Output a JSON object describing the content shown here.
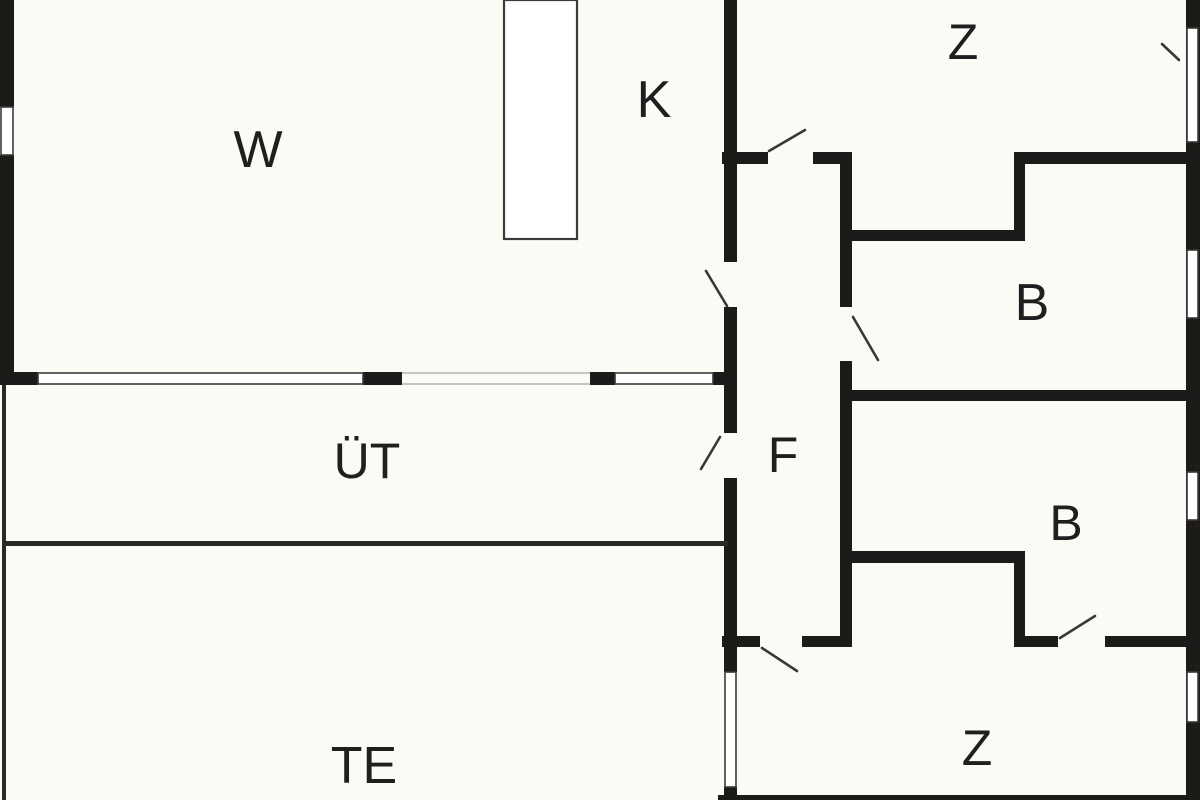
{
  "plan": {
    "title_hidden": "",
    "canvas": {
      "width": 1200,
      "height": 800
    },
    "colors": {
      "background": "#fbfaf4",
      "wall": "#1d1b19",
      "thin_wall": "#2b2926",
      "window_fill": "#ffffff",
      "window_stroke": "#3c3a38",
      "guide": "#b5b2ac",
      "door_swing": "#3a3836",
      "partition_stroke": "#3a3a3a",
      "label": "#1f1f1f"
    },
    "rooms": [
      {
        "id": "w",
        "label": "W",
        "x": 258,
        "y": 150,
        "size": 52
      },
      {
        "id": "k",
        "label": "K",
        "x": 654,
        "y": 100,
        "size": 52
      },
      {
        "id": "z-top",
        "label": "Z",
        "x": 963,
        "y": 42,
        "size": 50
      },
      {
        "id": "b-top",
        "label": "B",
        "x": 1032,
        "y": 303,
        "size": 52
      },
      {
        "id": "uet",
        "label": "ÜT",
        "x": 367,
        "y": 461,
        "size": 50
      },
      {
        "id": "f",
        "label": "F",
        "x": 783,
        "y": 455,
        "size": 50
      },
      {
        "id": "b-bottom",
        "label": "B",
        "x": 1066,
        "y": 523,
        "size": 50
      },
      {
        "id": "te",
        "label": "TE",
        "x": 364,
        "y": 766,
        "size": 52
      },
      {
        "id": "z-bottom",
        "label": "Z",
        "x": 977,
        "y": 748,
        "size": 50
      }
    ],
    "walls": [
      {
        "name": "outer-left-wall-top",
        "x": 0,
        "y": 0,
        "w": 14,
        "h": 107
      },
      {
        "name": "outer-left-wall-main",
        "x": 0,
        "y": 155,
        "w": 14,
        "h": 230
      },
      {
        "name": "w-south-wall-seg1",
        "x": 0,
        "y": 372,
        "w": 38,
        "h": 13
      },
      {
        "name": "w-south-wall-seg2",
        "x": 363,
        "y": 372,
        "w": 39,
        "h": 13
      },
      {
        "name": "w-south-wall-seg3",
        "x": 590,
        "y": 372,
        "w": 25,
        "h": 13
      },
      {
        "name": "w-south-wall-seg4",
        "x": 713,
        "y": 372,
        "w": 24,
        "h": 13
      },
      {
        "name": "k-z-divider-wall",
        "x": 724,
        "y": 0,
        "w": 13,
        "h": 262
      },
      {
        "name": "f-west-wall-mid",
        "x": 724,
        "y": 307,
        "w": 13,
        "h": 126
      },
      {
        "name": "f-west-wall-low",
        "x": 724,
        "y": 478,
        "w": 13,
        "h": 194
      },
      {
        "name": "te-z-divider-wall-stub",
        "x": 724,
        "y": 787,
        "w": 13,
        "h": 13
      },
      {
        "name": "z-top-south-wall-left-a",
        "x": 722,
        "y": 152,
        "w": 46,
        "h": 12
      },
      {
        "name": "z-top-south-wall-left-b",
        "x": 813,
        "y": 152,
        "w": 39,
        "h": 12
      },
      {
        "name": "z-top-south-wall-right",
        "x": 1014,
        "y": 152,
        "w": 186,
        "h": 12
      },
      {
        "name": "b-top-north-wall",
        "x": 845,
        "y": 230,
        "w": 177,
        "h": 11
      },
      {
        "name": "b-top-north-step-wall",
        "x": 1014,
        "y": 152,
        "w": 11,
        "h": 89
      },
      {
        "name": "b-top-south-wall",
        "x": 845,
        "y": 390,
        "w": 355,
        "h": 11
      },
      {
        "name": "f-east-wall-upper",
        "x": 840,
        "y": 164,
        "w": 12,
        "h": 143
      },
      {
        "name": "f-east-wall-lower",
        "x": 840,
        "y": 361,
        "w": 12,
        "h": 286
      },
      {
        "name": "b-bottom-north-wall",
        "x": 845,
        "y": 551,
        "w": 173,
        "h": 12
      },
      {
        "name": "b-bottom-step-wall",
        "x": 1014,
        "y": 551,
        "w": 11,
        "h": 96
      },
      {
        "name": "b-bottom-south-wall-a",
        "x": 1014,
        "y": 636,
        "w": 44,
        "h": 11
      },
      {
        "name": "b-bottom-south-wall-b",
        "x": 1105,
        "y": 636,
        "w": 95,
        "h": 11
      },
      {
        "name": "f-south-wall-a",
        "x": 722,
        "y": 636,
        "w": 38,
        "h": 11
      },
      {
        "name": "f-south-wall-b",
        "x": 802,
        "y": 636,
        "w": 50,
        "h": 11
      },
      {
        "name": "outer-right-wall",
        "x": 1186,
        "y": 0,
        "w": 14,
        "h": 800
      },
      {
        "name": "outer-bottom-wall-sliver",
        "x": 718,
        "y": 795,
        "w": 482,
        "h": 5
      }
    ],
    "thin_walls": [
      {
        "name": "uet-te-divider-line",
        "x": 2,
        "y": 541,
        "w": 726,
        "h": 5
      },
      {
        "name": "terrace-west-edge-line",
        "x": 2,
        "y": 385,
        "w": 4,
        "h": 415
      }
    ],
    "windows": [
      {
        "name": "window-w-west",
        "x": 1,
        "y": 107,
        "w": 12,
        "h": 48
      },
      {
        "name": "window-w-south-large",
        "x": 38,
        "y": 373,
        "w": 325,
        "h": 11
      },
      {
        "name": "window-w-south-small",
        "x": 615,
        "y": 373,
        "w": 98,
        "h": 11
      },
      {
        "name": "window-te-z-divider",
        "x": 725,
        "y": 672,
        "w": 11,
        "h": 115
      },
      {
        "name": "window-z-top-east",
        "x": 1187,
        "y": 28,
        "w": 11,
        "h": 114
      },
      {
        "name": "window-b-top-east",
        "x": 1187,
        "y": 250,
        "w": 11,
        "h": 68
      },
      {
        "name": "window-b-bottom-east",
        "x": 1187,
        "y": 472,
        "w": 11,
        "h": 48
      },
      {
        "name": "window-z-bottom-east",
        "x": 1187,
        "y": 672,
        "w": 11,
        "h": 50
      }
    ],
    "opening_guides": [
      {
        "name": "w-uet-opening-top-guide",
        "x1": 402,
        "y1": 373,
        "x2": 590,
        "y2": 373
      },
      {
        "name": "w-uet-opening-bottom-guide",
        "x1": 402,
        "y1": 384,
        "x2": 590,
        "y2": 384
      }
    ],
    "door_swings": [
      {
        "name": "door-swing-z-top",
        "x1": 769,
        "y1": 151,
        "x2": 805,
        "y2": 130
      },
      {
        "name": "door-swing-k",
        "x1": 706,
        "y1": 271,
        "x2": 727,
        "y2": 306
      },
      {
        "name": "door-swing-b-top",
        "x1": 853,
        "y1": 317,
        "x2": 878,
        "y2": 360
      },
      {
        "name": "door-swing-uet",
        "x1": 720,
        "y1": 437,
        "x2": 701,
        "y2": 469
      },
      {
        "name": "door-swing-z-bottom",
        "x1": 762,
        "y1": 648,
        "x2": 797,
        "y2": 671
      },
      {
        "name": "door-swing-b-bottom",
        "x1": 1060,
        "y1": 638,
        "x2": 1095,
        "y2": 616
      },
      {
        "name": "window-tick-z-top-east",
        "x1": 1162,
        "y1": 44,
        "x2": 1179,
        "y2": 60
      }
    ],
    "partition": {
      "name": "w-k-partition-column",
      "x": 504,
      "y": 0,
      "w": 73,
      "h": 239
    }
  }
}
